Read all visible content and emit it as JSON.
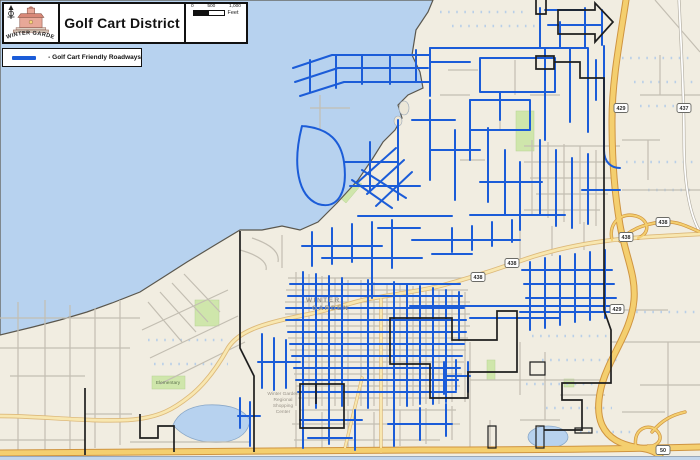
{
  "header": {
    "logo_text": "WINTER GARDEN",
    "title": "Golf Cart District",
    "scale": {
      "t0": "0",
      "t1": "500",
      "t2": "1,000",
      "unit": "Feet"
    }
  },
  "legend": {
    "items": [
      {
        "label": "- Golf Cart Friendly Roadways",
        "color": "#1b5cd8"
      }
    ]
  },
  "map": {
    "shields": [
      "438",
      "438",
      "438",
      "438",
      "429",
      "429",
      "437",
      "50"
    ],
    "labels": {
      "city": [
        "WINTER",
        "GARDEN"
      ],
      "shopping_center": [
        "Winter Garden",
        "Regional",
        "Shopping",
        "Center"
      ],
      "elementary": "Elementary"
    }
  },
  "colors": {
    "golf_cart_blue": "#1b5cd8",
    "water": "#b7d2ef",
    "highway_yellow": "#f4cf6f",
    "district_boundary": "#1e1e1e",
    "land": "#f1ede1",
    "park_green": "#cfe6ab"
  }
}
